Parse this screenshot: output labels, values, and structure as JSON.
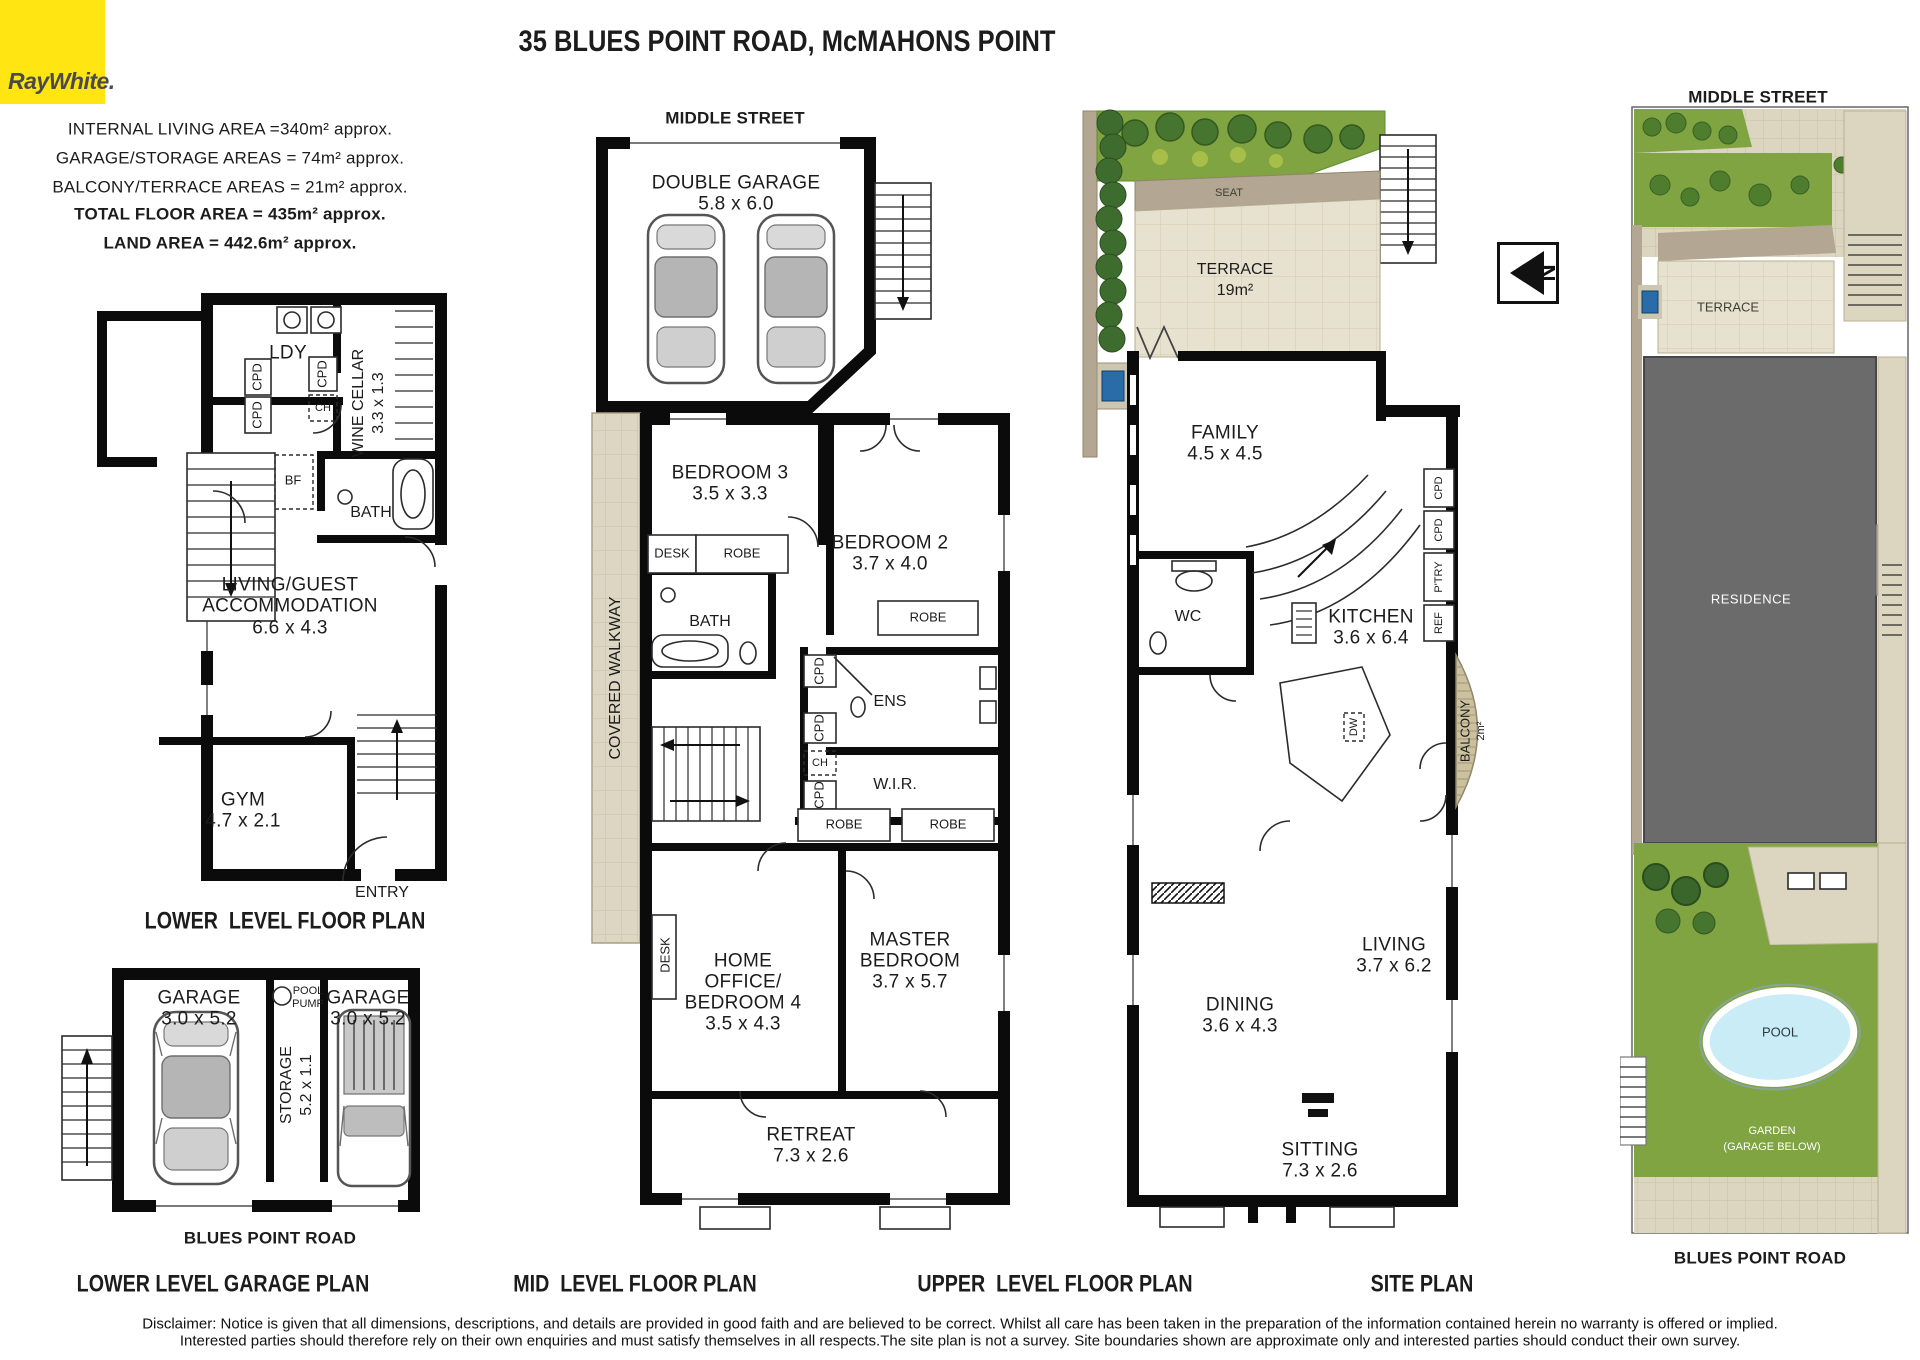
{
  "brand": {
    "logo_text": "RayWhite."
  },
  "header": {
    "title": "35 BLUES POINT ROAD, McMAHONS POINT"
  },
  "area_summary": {
    "internal": "INTERNAL LIVING AREA =340m² approx.",
    "garage": "GARAGE/STORAGE AREAS = 74m² approx.",
    "balcony": "BALCONY/TERRACE AREAS = 21m² approx.",
    "total": "TOTAL FLOOR AREA = 435m² approx.",
    "land": "LAND AREA = 442.6m² approx."
  },
  "compass": {
    "north": "N"
  },
  "lower_level": {
    "caption": "LOWER  LEVEL FLOOR PLAN",
    "rooms": {
      "ldy": "LDY",
      "cpd_a": "CPD",
      "cpd_b": "CPD",
      "cpd_c": "CPD",
      "ch": "CH",
      "wine_cellar": "WINE CELLAR",
      "wine_cellar_dims": "3.3 x 1.3",
      "bf": "BF",
      "bath": "BATH",
      "living_line1": "LIVING/GUEST",
      "living_line2": "ACCOMMODATION",
      "living_dims": "6.6 x 4.3",
      "gym": "GYM",
      "gym_dims": "4.7 x 2.1",
      "entry": "ENTRY"
    }
  },
  "garage_plan": {
    "caption": "LOWER LEVEL GARAGE PLAN",
    "street": "BLUES POINT ROAD",
    "rooms": {
      "garage_left": "GARAGE",
      "garage_left_dims": "3.0 x 5.2",
      "garage_right": "GARAGE",
      "garage_right_dims": "3.0 x 5.2",
      "storage": "STORAGE",
      "storage_dims": "5.2 x 1.1",
      "pool_pump_line1": "POOL",
      "pool_pump_line2": "PUMP"
    }
  },
  "mid_level": {
    "caption": "MID  LEVEL FLOOR PLAN",
    "street": "MIDDLE STREET",
    "rooms": {
      "double_garage": "DOUBLE GARAGE",
      "double_garage_dims": "5.8 x 6.0",
      "covered_walkway": "COVERED WALKWAY",
      "bedroom3": "BEDROOM 3",
      "bedroom3_dims": "3.5 x 3.3",
      "desk1": "DESK",
      "robe1": "ROBE",
      "bath": "BATH",
      "bedroom2": "BEDROOM 2",
      "bedroom2_dims": "3.7 x 4.0",
      "robe2": "ROBE",
      "ens": "ENS",
      "wir": "W.I.R.",
      "cpd_a": "CPD",
      "cpd_b": "CPD",
      "ch": "CH",
      "cpd_c": "CPD",
      "robe3": "ROBE",
      "robe4": "ROBE",
      "home_office_line1": "HOME",
      "home_office_line2": "OFFICE/",
      "home_office_line3": "BEDROOM 4",
      "home_office_dims": "3.5 x 4.3",
      "desk2": "DESK",
      "master_line1": "MASTER",
      "master_line2": "BEDROOM",
      "master_dims": "3.7 x 5.7",
      "retreat": "RETREAT",
      "retreat_dims": "7.3 x 2.6"
    }
  },
  "upper_level": {
    "caption": "UPPER  LEVEL FLOOR PLAN",
    "rooms": {
      "seat": "SEAT",
      "terrace": "TERRACE",
      "terrace_dims": "19m²",
      "family": "FAMILY",
      "family_dims": "4.5 x 4.5",
      "wc": "WC",
      "kitchen": "KITCHEN",
      "kitchen_dims": "3.6 x 6.4",
      "cpd_a": "CPD",
      "cpd_b": "CPD",
      "ptry": "P'TRY",
      "ref": "REF",
      "dw": "DW",
      "balcony": "BALCONY",
      "balcony_dims": "2m²",
      "dining": "DINING",
      "dining_dims": "3.6 x 4.3",
      "living": "LIVING",
      "living_dims": "3.7 x 6.2",
      "sitting": "SITTING",
      "sitting_dims": "7.3 x 2.6"
    }
  },
  "site_plan": {
    "caption": "SITE PLAN",
    "street_top": "MIDDLE STREET",
    "street_bottom": "BLUES POINT ROAD",
    "labels": {
      "terrace": "TERRACE",
      "residence": "RESIDENCE",
      "pool": "POOL",
      "garden_line1": "GARDEN",
      "garden_line2": "(GARAGE BELOW)"
    }
  },
  "disclaimer": {
    "line1": "Disclaimer: Notice is given that all dimensions, descriptions, and details are provided in good faith and are believed to be correct. Whilst all care has been taken in the preparation of the information contained herein no warranty is offered or implied.",
    "line2": "Interested parties should therefore rely on their own enquiries and must satisfy themselves in all respects.The site plan is not a survey. Site boundaries shown are approximate only and interested parties should conduct their own survey."
  },
  "colors": {
    "raywhite_yellow": "#FFE512",
    "logo_text_grey": "#4A4A4A",
    "wall_black": "#0B0B0B",
    "walkway_tan": "#DCD5BF",
    "terrace_tile": "#E7E1D0",
    "garden_green": "#7FA441",
    "hedge_green": "#3E6B2E",
    "tree_green": "#46752F",
    "pool_blue": "#C9ECF6",
    "spa_blue": "#2A6CA8",
    "residence_grey": "#6B6B6B",
    "boundary_beige": "#B3A692"
  }
}
